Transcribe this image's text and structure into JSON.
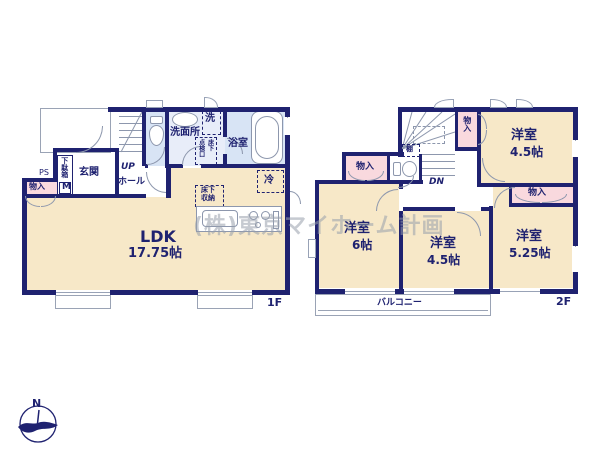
{
  "plan": {
    "watermark": "(株)東京マイホーム計画",
    "compass": {
      "north": "N"
    },
    "floor1": {
      "label": "1F",
      "ldk": {
        "name": "LDK",
        "size": "17.75帖"
      },
      "genkan": "玄関",
      "getabako": "下駄箱",
      "meter": "M",
      "ps": "PS",
      "closet": "物入",
      "up": "UP",
      "hall": "ホール",
      "senmenjo": "洗面所",
      "washer": "洗",
      "inspection_col_right": "床下",
      "inspection_col_left": "点検口",
      "bath": "浴室",
      "fridge": "冷",
      "floor_storage_line1": "床下",
      "floor_storage_line2": "収納"
    },
    "floor2": {
      "label": "2F",
      "closet": "物入",
      "shelf": "棚",
      "dn": "DN",
      "balcony": "バルコニー",
      "rooms": [
        {
          "name": "洋室",
          "size": "4.5帖"
        },
        {
          "name": "洋室",
          "size": "6帖"
        },
        {
          "name": "洋室",
          "size": "4.5帖"
        },
        {
          "name": "洋室",
          "size": "5.25帖"
        }
      ]
    },
    "colors": {
      "wall": "#1f2270",
      "room_beige": "#f7e8c8",
      "closet_pink": "#f9d9de",
      "wet_blue": "#d8e4f5",
      "line_gray": "#8d97ad"
    }
  }
}
